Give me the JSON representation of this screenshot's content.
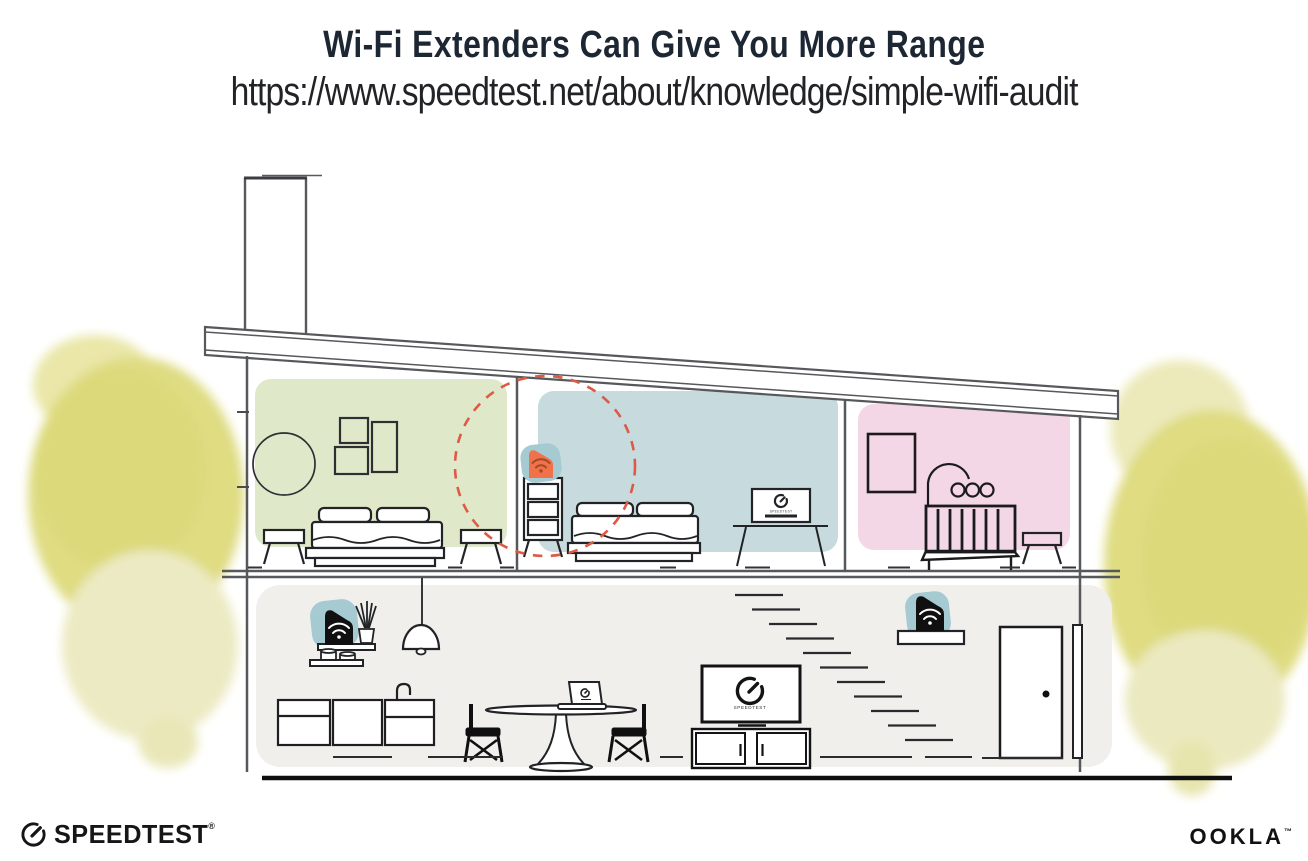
{
  "header": {
    "title": "Wi-Fi Extenders Can Give You More Range",
    "url": "https://www.speedtest.net/about/knowledge/simple-wifi-audit"
  },
  "screens": {
    "bedroom_tv_label": "SPEEDTEST",
    "living_tv_label": "SPEEDTEST"
  },
  "footer": {
    "speedtest_wordmark": "SPEEDTEST",
    "speedtest_registered_mark": "®",
    "ookla_wordmark": "OOKLA",
    "ookla_trademark": "™"
  },
  "scene": {
    "rooms": [
      {
        "name": "bedroom-left",
        "wall_color": "#dfe9ca"
      },
      {
        "name": "bedroom-middle",
        "wall_color": "#c7dadd"
      },
      {
        "name": "nursery",
        "wall_color": "#f4d7e6"
      },
      {
        "name": "living-area",
        "wall_color": "#f0efec"
      }
    ],
    "devices": [
      {
        "name": "wifi-extender-bedroom",
        "icon": "wifi-icon",
        "accent": "#f0714a",
        "backdrop": "#a5cad2",
        "highlight": "dashed-red-circle"
      },
      {
        "name": "router-living-left",
        "icon": "wifi-icon",
        "body": "#111111",
        "backdrop": "#a5cad2"
      },
      {
        "name": "wifi-extender-living-right",
        "icon": "wifi-icon",
        "body": "#111111",
        "backdrop": "#a5cad2"
      }
    ],
    "colors": {
      "outline": "#57585c",
      "furniture": "#222326",
      "dashed_circle": "#dd5a45",
      "foliage": "#dfdc82",
      "foliage_light": "#eceac2",
      "ground": "#0f0f0f"
    }
  }
}
